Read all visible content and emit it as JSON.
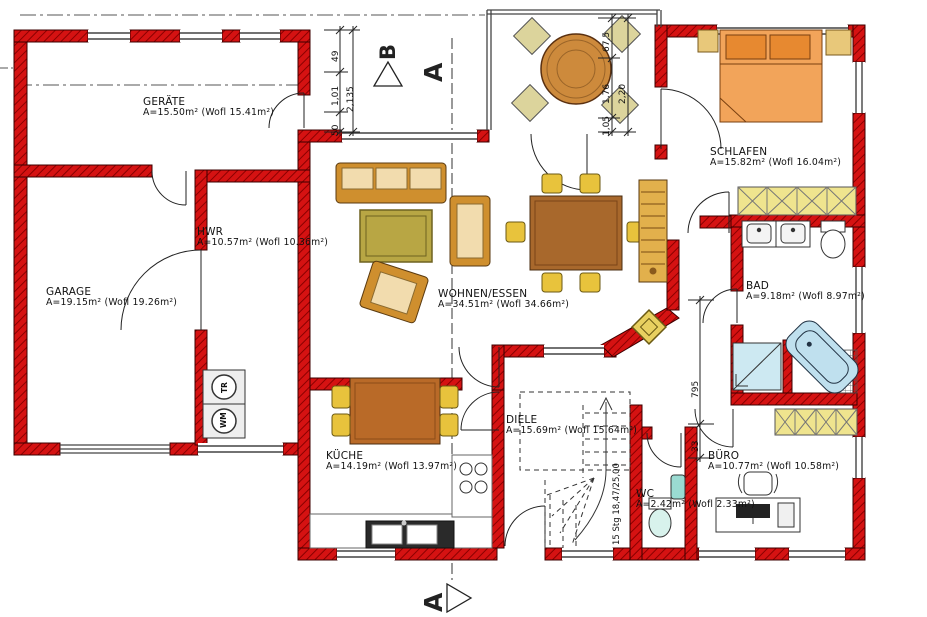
{
  "rooms": {
    "geraete": {
      "name": "GERÄTE",
      "area": "A=15.50m² (Wofl 15.41m²)"
    },
    "garage": {
      "name": "GARAGE",
      "area": "A=19.15m² (Wofl 19.26m²)"
    },
    "hwr": {
      "name": "HWR",
      "area": "A=10.57m² (Wofl 10.36m²)"
    },
    "wohnen_essen": {
      "name": "WOHNEN/ESSEN",
      "area": "A=34.51m² (Wofl 34.66m²)"
    },
    "schlafen": {
      "name": "SCHLAFEN",
      "area": "A=15.82m² (Wofl 16.04m²)"
    },
    "bad": {
      "name": "BAD",
      "area": "A=9.18m² (Wofl 8.97m²)"
    },
    "kueche": {
      "name": "KÜCHE",
      "area": "A=14.19m² (Wofl 13.97m²)"
    },
    "diele": {
      "name": "DIELE",
      "area": "A=15.69m² (Wofl 15.64m²)"
    },
    "wc": {
      "name": "WC",
      "area": "A=2.42m² (Wofl 2.33m²)"
    },
    "buero": {
      "name": "BÜRO",
      "area": "A=10.77m² (Wofl 10.58m²)"
    }
  },
  "dimensions": {
    "left_chain": {
      "v1": "49",
      "v2": "1,01",
      "v3": "50",
      "total": "2,135"
    },
    "bay_chain": {
      "v1": "67,5",
      "v2": "1,76",
      "v3": "1,05",
      "total": "2,20"
    },
    "right_chain": {
      "v1": "795",
      "v2": "33"
    }
  },
  "stairs": {
    "note": "15 Stg 18,47/25,00"
  },
  "appliances": {
    "dryer": "TR",
    "washer": "WM"
  },
  "section_markers": {
    "b_top": "B",
    "a_top": "A",
    "a_bottom": "A"
  },
  "colors": {
    "wall": "#d51212",
    "wall_hatch": "#8a0000",
    "wood": "#b97a3c",
    "chair_yellow": "#e8c33c",
    "bed_orange": "#f2a45a",
    "wardrobe_yellow": "#efe48e",
    "water_blue": "#bfe0ee",
    "rug_olive": "#b8a644"
  }
}
